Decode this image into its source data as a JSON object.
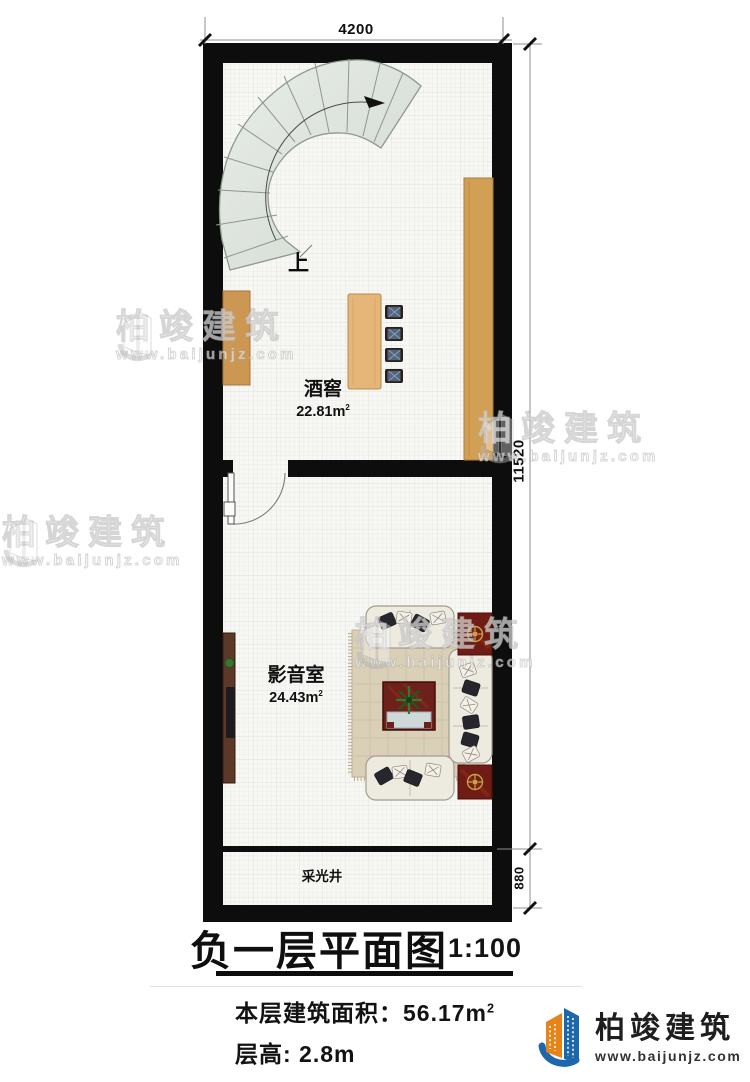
{
  "plan": {
    "rooms": {
      "wine_cellar": {
        "name": "酒窖",
        "area": "22.81m",
        "area_sup": "2"
      },
      "media_room": {
        "name": "影音室",
        "area": "24.43m",
        "area_sup": "2"
      },
      "light_well": {
        "name": "采光井"
      }
    },
    "stairs": {
      "direction_label": "上"
    },
    "dimensions": {
      "top_width": "4200",
      "right_height": "11520",
      "light_well_depth": "880"
    }
  },
  "title_block": {
    "title": "负一层平面图",
    "scale": "1:100",
    "floor_area_label": "本层建筑面积：56.17m",
    "floor_area_sup": "2",
    "floor_height_label": "层高: 2.8m"
  },
  "branding": {
    "company": "柏竣建筑",
    "website": "www.baijunjz.com"
  },
  "watermark": {
    "company": "柏竣建筑",
    "website": "www.baijunjz.com"
  },
  "colors": {
    "wall": "#0d0d0d",
    "wood": "#d2a055",
    "stair_tread": "#dfe5dd",
    "rug": "#d9cdb6",
    "mat_red": "#6f1c14",
    "logo_blue": "#1d67ad",
    "logo_orange": "#e8831a"
  }
}
